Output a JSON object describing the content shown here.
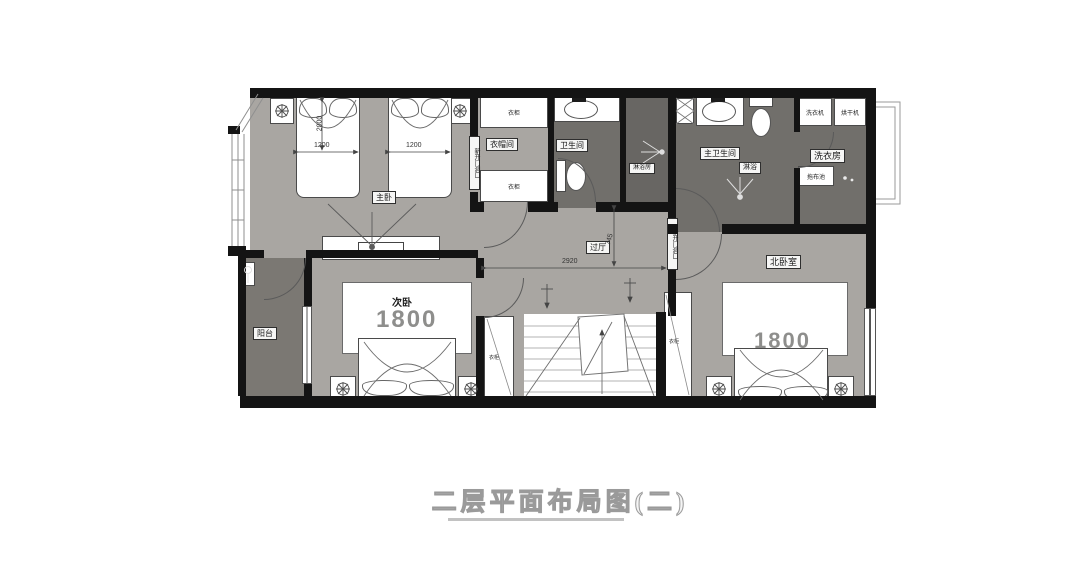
{
  "title": "二层平面布局图(二)",
  "rooms": {
    "master": "主卧",
    "cloak": "衣帽间",
    "bath": "卫生间",
    "shower": "淋浴房",
    "mbath": "主卫生间",
    "mshower": "淋浴",
    "laundry": "洗衣房",
    "hall": "过厅",
    "balcony": "阳台",
    "second": "次卧",
    "north": "北卧室"
  },
  "furniture": {
    "wardrobe": "衣柜",
    "washer": "洗衣机",
    "dryer": "烘干机",
    "mop_sink": "拖布池"
  },
  "dims": {
    "master_bed_1": "1200",
    "master_bed_2": "1200",
    "master_bed_len": "2000",
    "second_bed": "1800",
    "north_bed": "1800",
    "hall_w": "2920",
    "hall_d": "745"
  },
  "annotations": {
    "wall_note": "新开门洞口"
  },
  "colors": {
    "wall": "#141414",
    "floor_light": "#a9a6a2",
    "floor_dark": "#716f6b",
    "floor_balcony": "#7b7873"
  }
}
